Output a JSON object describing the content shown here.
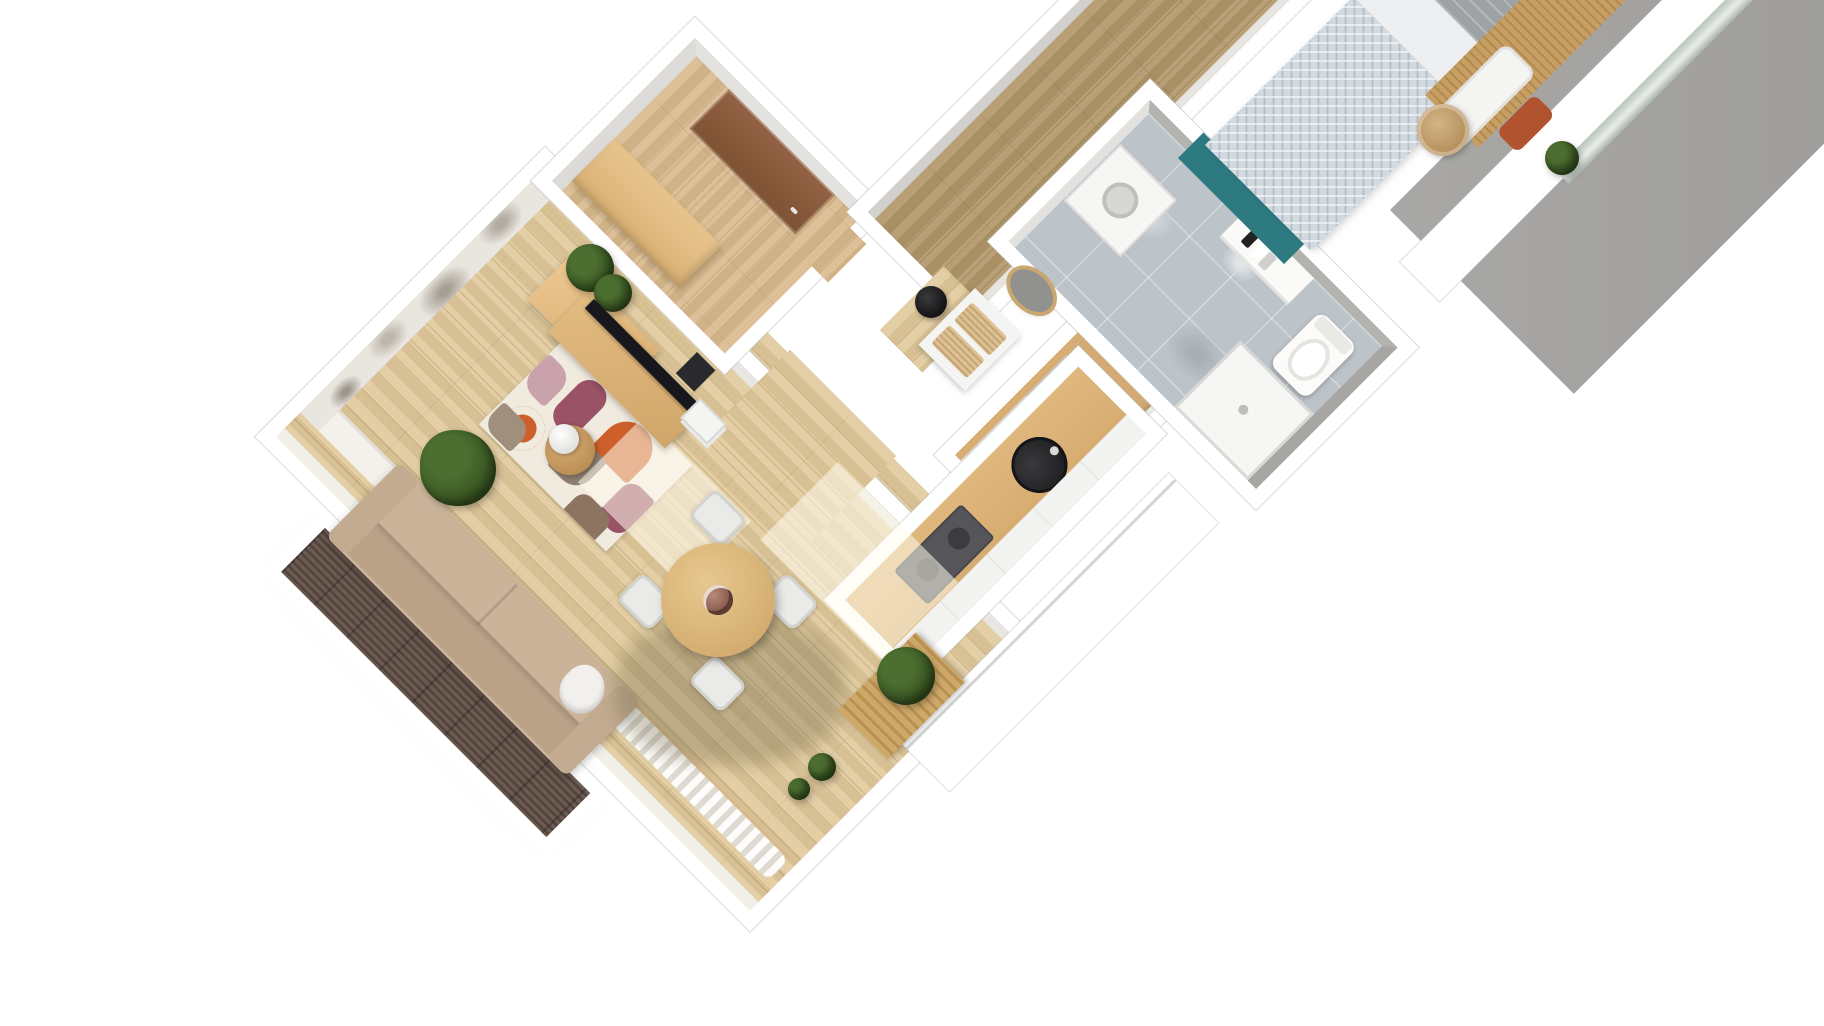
{
  "scene": {
    "title": "apartment-3d-floor-plan-render",
    "view": "top-down-3d",
    "background": "#ffffff",
    "rooms": [
      {
        "name": "living-room",
        "floor": "light oak parquet",
        "furniture": [
          "beige sofa",
          "abstract multicolor rug",
          "tv on wood media console",
          "tall wood shelf with plant",
          "round side table with lamp",
          "large green floor plant",
          "gray mural wallpaper wall",
          "window wall with sheer curtains"
        ]
      },
      {
        "name": "dining-area",
        "floor": "light oak parquet",
        "furniture": [
          "round wood dining table",
          "white chair north",
          "white chair east",
          "white chair south",
          "white chair west",
          "flower centerpiece"
        ]
      },
      {
        "name": "entry-hall",
        "floor": "oak parquet",
        "furniture": [
          "brown front door",
          "light wood sideboard"
        ]
      },
      {
        "name": "hallway",
        "floor": "olive oak parquet",
        "furniture": [
          "oval wall mirror",
          "white console with rattan drawers",
          "black pendant lamp"
        ]
      },
      {
        "name": "kitchen",
        "floor": "light oak parquet",
        "furniture": [
          "wood countertop",
          "round black sink",
          "dark gray cooktop",
          "white cabinet fronts",
          "white fridge unit",
          "gray tall unit",
          "slatted wood bench with plant",
          "small potted plants"
        ]
      },
      {
        "name": "bathroom",
        "floor": "gray marble tile",
        "furniture": [
          "white toilet",
          "vanity with toiletries",
          "shower tray",
          "washer unit"
        ]
      },
      {
        "name": "bedroom",
        "floor": "wood with teal rug",
        "furniture": [
          "double bed with patterned duvet",
          "gray blanket",
          "white pillows",
          "wood slat headboard",
          "round rattan side table",
          "terracotta cushion",
          "green plant",
          "tall gray wall",
          "glazed window strip"
        ]
      },
      {
        "name": "balcony",
        "floor": "dark wood decking",
        "furniture": []
      }
    ],
    "palette": {
      "wallWhite": "#ffffff",
      "wallGray": "#d2d1ce",
      "wallDark": "#a7a6a2",
      "floorLight": "#e0c99b",
      "floorLine": "#c5a876",
      "floorHall": "#b29769",
      "hallLine": "#99805a",
      "floorEntry": "#d9b98c",
      "entryLine": "#c1a272",
      "deck": "#5d4e45",
      "counterWood": "#d8ad73",
      "cabinet": "#f2f2f0",
      "sink": "#2b2b2d",
      "hob": "#55555a",
      "tile": "#bcc3c9",
      "tileLight": "#d6dade",
      "rugBase": "#f1eadf",
      "rugOrange": "#cd5f2b",
      "rugMauve": "#9a5266",
      "rugBlush": "#c9a2ac",
      "rugTaupe": "#8e8070",
      "sofaSeat": "#cab399",
      "sofaBack": "#b9a287",
      "sofaArm": "#c2ab90",
      "tableWood": "#dbb87e",
      "chairWhite": "#eaeae8",
      "duvet": "#d3dadf",
      "blanketGray": "#9ca2a6",
      "teal": "#2d7a81",
      "rattan": "#c3a274",
      "terracotta": "#b2532f",
      "slat": "#c89f63",
      "slatDark": "#b08a4e",
      "door": "#8a5a3a",
      "plant": "#4c6e30",
      "plantDark": "#35511f",
      "black": "#1c1c1e",
      "mirror": "#919190",
      "sill": "#f4f1ec",
      "shadow": "rgba(104,92,64,0.30)",
      "light": "rgba(255,251,236,0.55)"
    }
  }
}
